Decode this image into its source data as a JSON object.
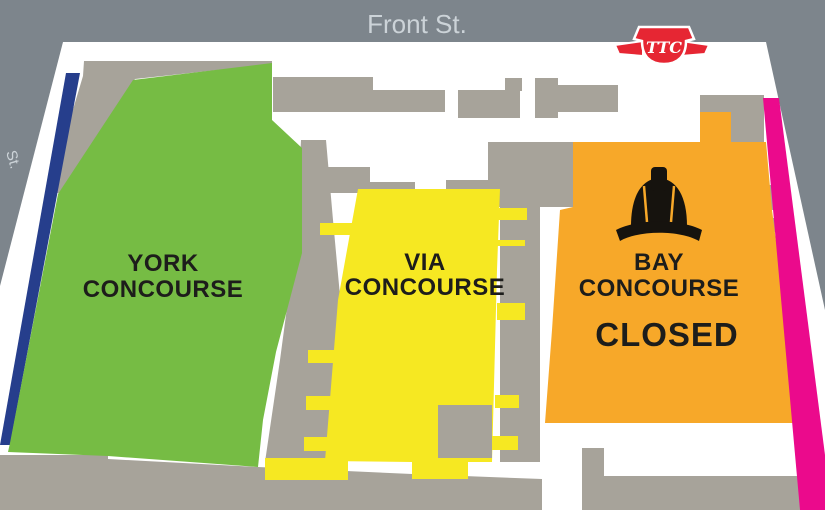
{
  "map": {
    "streets": {
      "front_street": "Front St.",
      "left_street_fragment": "St."
    },
    "concourses": {
      "york": {
        "line1": "YORK",
        "line2": "CONCOURSE"
      },
      "via": {
        "line1": "VIA",
        "line2": "CONCOURSE"
      },
      "bay": {
        "line1": "BAY",
        "line2": "CONCOURSE",
        "status": "CLOSED"
      }
    },
    "logo": {
      "monogram": "TTC"
    },
    "icons": {
      "hard_hat": "hard-hat-icon",
      "ttc_logo": "ttc-logo-icon"
    }
  },
  "colors": {
    "street-gray": "#7d858c",
    "building-gray": "#a7a39a",
    "york-green": "#76bc44",
    "via-yellow": "#f6e822",
    "bay-orange": "#f7a829",
    "path-blue": "#263e8c",
    "path-pink": "#eb0a8c",
    "ttc-red": "#e62633",
    "label-black": "#1d1d1b",
    "street-label": "#ccd3d8",
    "hat-black": "#16130e",
    "white": "#ffffff"
  }
}
